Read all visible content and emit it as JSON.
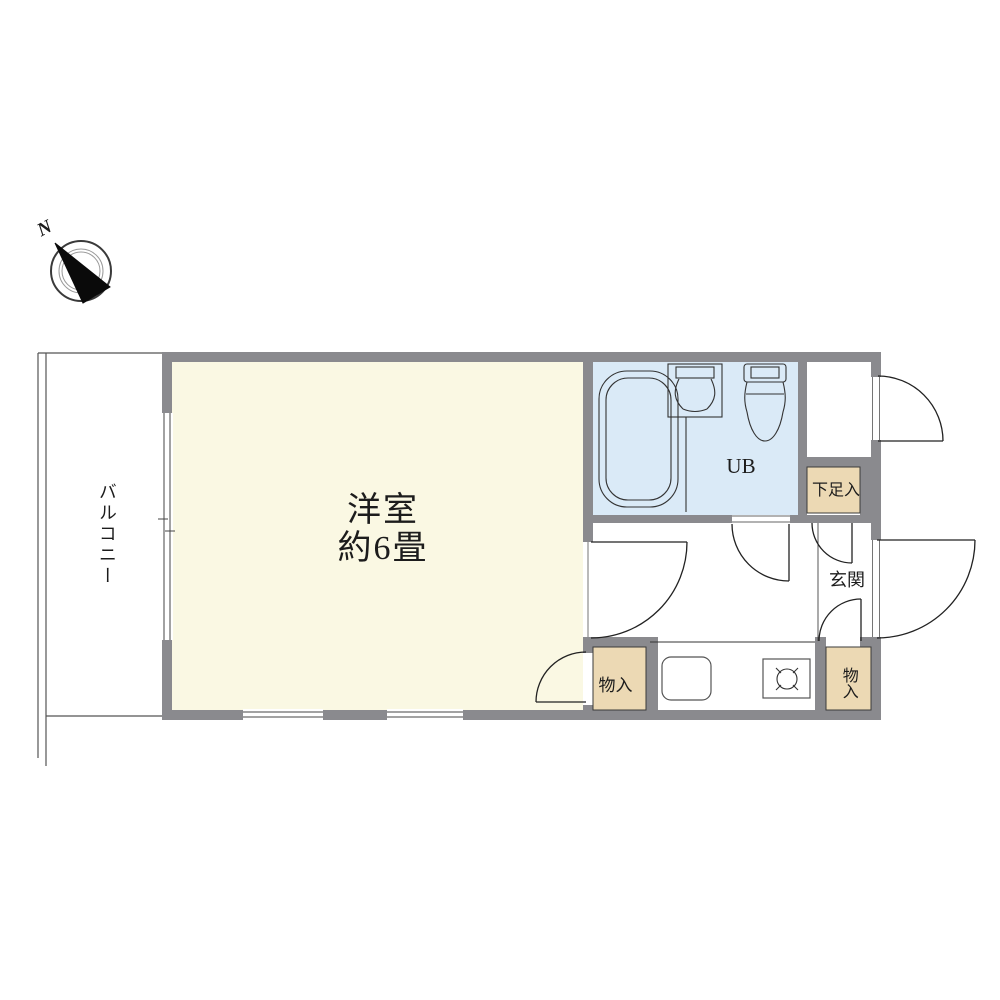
{
  "page": {
    "background": "#ffffff"
  },
  "colors": {
    "wall": "#8a8a8e",
    "main_room_fill": "#faf8e3",
    "bath_fill": "#daeaf7",
    "storage_fill": "#ecd9b4",
    "floor_white": "#ffffff",
    "line": "#2a2a2a",
    "thin_line": "#555555"
  },
  "compass": {
    "north_label": "N"
  },
  "rooms": {
    "balcony": {
      "label": "バルコニー"
    },
    "main": {
      "label_line1": "洋室",
      "label_line2": "約6畳"
    },
    "unit_bath": {
      "label": "UB"
    },
    "shoe_storage": {
      "label": "下足入"
    },
    "entrance": {
      "label": "玄関"
    },
    "storage_left": {
      "label": "物入"
    },
    "storage_right": {
      "label": "物入"
    }
  }
}
